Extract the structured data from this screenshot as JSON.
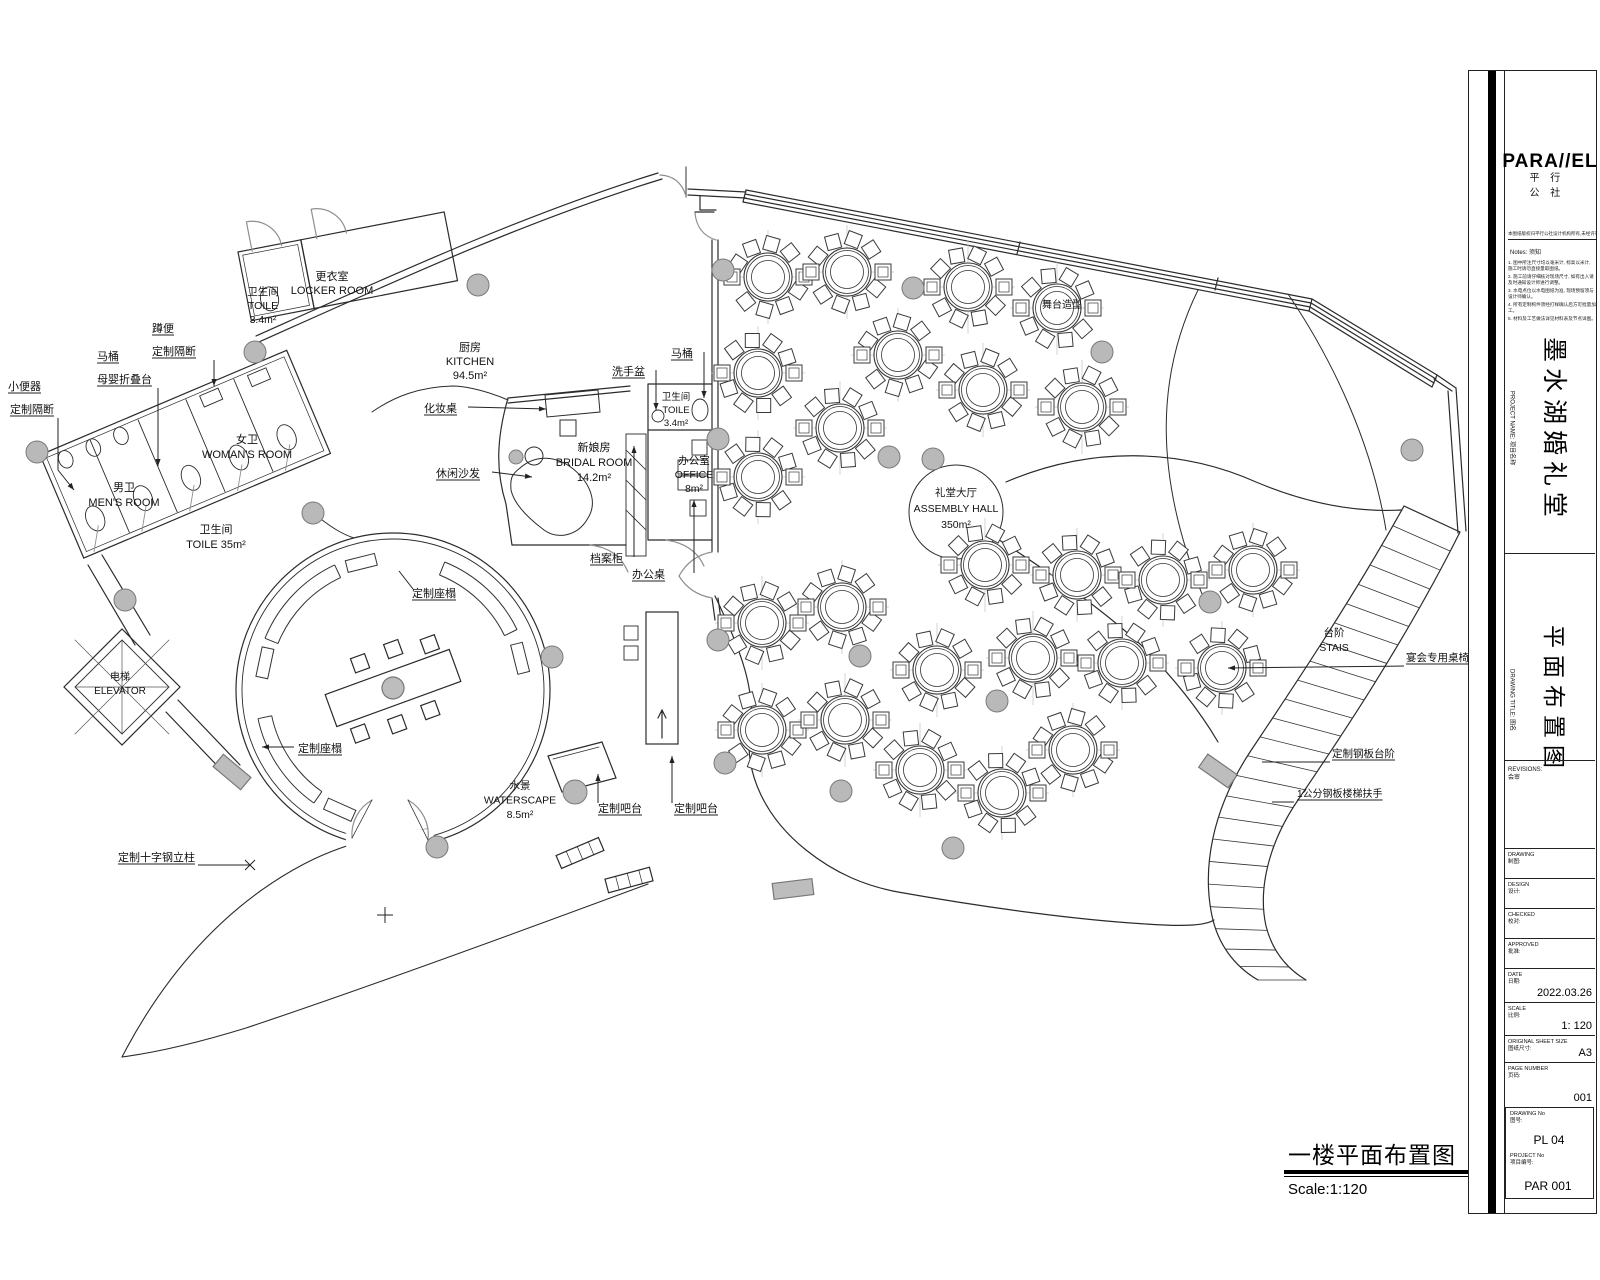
{
  "title_block": {
    "logo": "PARA//EL",
    "logo_sub": "平 行 公 社",
    "copyright_line": "本图纸版权归平行公社设计机构所有,未经许可不得复制",
    "notes_title": "Notes:  须知",
    "notes_items": [
      "1. 图中所注尺寸均以毫米计, 标高以米计, 施工时请勿直接量取图纸。",
      "2. 施工前请仔细核对现场尺寸, 如有出入请及时通知设计师进行调整。",
      "3. 水电点位以水电图纸为准, 现场预留须与设计师确认。",
      "4. 所有定制构件须经打样确认后方可批量加工。",
      "5. 材料及工艺做法详见材料表及节点详图。"
    ],
    "project_name_label": "PROJECT NAME:  项目名称",
    "project_name": "墨水湖婚礼堂",
    "drawing_title_label": "DRAWING TITLE:  图名",
    "drawing_title": "平面布置图",
    "revisions_en": "REVISIONS:",
    "revisions_cn": "会审",
    "fields": [
      {
        "en": "DRAWING",
        "cn": "制图:",
        "value": "",
        "y": 848,
        "h": 30
      },
      {
        "en": "DESIGN",
        "cn": "设计:",
        "value": "",
        "y": 878,
        "h": 30
      },
      {
        "en": "CHECKED",
        "cn": "校对:",
        "value": "",
        "y": 908,
        "h": 30
      },
      {
        "en": "APPROVED",
        "cn": "批准:",
        "value": "",
        "y": 938,
        "h": 30
      },
      {
        "en": "DATE",
        "cn": "日期:",
        "value": "2022.03.26",
        "y": 968,
        "h": 34
      },
      {
        "en": "SCALE",
        "cn": "比例:",
        "value": "1:  120",
        "y": 1002,
        "h": 33
      },
      {
        "en": "ORIGINAL SHEET SIZE",
        "cn": "图纸尺寸:",
        "value": "A3",
        "y": 1035,
        "h": 27
      },
      {
        "en": "PAGE NUMBER",
        "cn": "页码:",
        "value": "001",
        "y": 1062,
        "h": 45
      }
    ],
    "drawing_no_label_en": "DRAWING No",
    "drawing_no_label_cn": "图号:",
    "drawing_no": "PL 04",
    "project_no_label_en": "PROJECT No",
    "project_no_label_cn": "项目编号:",
    "project_no": "PAR 001"
  },
  "plan_title": {
    "cn": "一楼平面布置图",
    "scale": "Scale:1:120"
  },
  "plan": {
    "labels": [
      {
        "x": 332,
        "y": 280,
        "fs": 11,
        "lh": 14,
        "a": "m",
        "lines": [
          "更衣室",
          "LOCKER ROOM"
        ]
      },
      {
        "x": 263,
        "y": 295,
        "fs": 10.5,
        "lh": 14,
        "a": "m",
        "lines": [
          "卫生间",
          "TOILE",
          "3.4m²"
        ]
      },
      {
        "x": 470,
        "y": 351,
        "fs": 11,
        "lh": 14,
        "a": "m",
        "lines": [
          "厨房",
          "KITCHEN",
          "94.5m²"
        ]
      },
      {
        "x": 594,
        "y": 451,
        "fs": 11,
        "lh": 15,
        "a": "m",
        "lines": [
          "新娘房",
          "BRIDAL ROOM",
          "14.2m²"
        ]
      },
      {
        "x": 676,
        "y": 400,
        "fs": 9.5,
        "lh": 13,
        "a": "m",
        "lines": [
          "卫生间",
          "TOILE",
          "3.4m²"
        ]
      },
      {
        "x": 694,
        "y": 464,
        "fs": 10.5,
        "lh": 14,
        "a": "m",
        "lines": [
          "办公室",
          "OFFICE",
          "8m²"
        ]
      },
      {
        "x": 247,
        "y": 443,
        "fs": 11,
        "lh": 15,
        "a": "m",
        "lines": [
          "女卫",
          "WOMAN'S ROOM"
        ]
      },
      {
        "x": 124,
        "y": 491,
        "fs": 11,
        "lh": 15,
        "a": "m",
        "lines": [
          "男卫",
          "MEN'S ROOM"
        ]
      },
      {
        "x": 216,
        "y": 533,
        "fs": 11,
        "lh": 15,
        "a": "m",
        "lines": [
          "卫生间",
          "TOILE 35m²"
        ]
      },
      {
        "x": 120,
        "y": 680,
        "fs": 10,
        "lh": 14,
        "a": "m",
        "lines": [
          "电梯",
          "ELEVATOR"
        ]
      },
      {
        "x": 1334,
        "y": 636,
        "fs": 10.5,
        "lh": 15,
        "a": "m",
        "lines": [
          "台阶",
          "STAIS"
        ]
      },
      {
        "x": 520,
        "y": 789,
        "fs": 10.5,
        "lh": 14.5,
        "a": "m",
        "lines": [
          "水景",
          "WATERSCAPE",
          "8.5m²"
        ]
      },
      {
        "x": 956,
        "y": 496,
        "fs": 10.5,
        "lh": 16,
        "a": "m",
        "lines": [
          "礼堂大厅",
          "ASSEMBLY HALL",
          "350m²"
        ]
      },
      {
        "x": 1062,
        "y": 308,
        "fs": 10,
        "lh": 13,
        "a": "m",
        "lines": [
          "舞台造型"
        ]
      },
      {
        "x": 8,
        "y": 390,
        "ul": true,
        "lines": [
          "小便器"
        ]
      },
      {
        "x": 10,
        "y": 413,
        "ul": true,
        "lines": [
          "定制隔断"
        ]
      },
      {
        "x": 97,
        "y": 360,
        "ul": true,
        "lines": [
          "马桶"
        ]
      },
      {
        "x": 97,
        "y": 383,
        "ul": true,
        "lines": [
          "母婴折叠台"
        ]
      },
      {
        "x": 152,
        "y": 332,
        "ul": true,
        "lines": [
          "蹲便"
        ]
      },
      {
        "x": 152,
        "y": 355,
        "ul": true,
        "lines": [
          "定制隔断"
        ]
      },
      {
        "x": 424,
        "y": 412,
        "ul": true,
        "lines": [
          "化妆桌"
        ]
      },
      {
        "x": 436,
        "y": 477,
        "ul": true,
        "lines": [
          "休闲沙发"
        ]
      },
      {
        "x": 612,
        "y": 375,
        "ul": true,
        "lines": [
          "洗手盆"
        ]
      },
      {
        "x": 671,
        "y": 357,
        "ul": true,
        "lines": [
          "马桶"
        ]
      },
      {
        "x": 590,
        "y": 562,
        "ul": true,
        "lines": [
          "档案柜"
        ]
      },
      {
        "x": 632,
        "y": 578,
        "ul": true,
        "lines": [
          "办公桌"
        ]
      },
      {
        "x": 412,
        "y": 597,
        "ul": true,
        "lines": [
          "定制座榻"
        ]
      },
      {
        "x": 298,
        "y": 752,
        "ul": true,
        "lines": [
          "定制座榻"
        ]
      },
      {
        "x": 598,
        "y": 812,
        "ul": true,
        "lines": [
          "定制吧台"
        ]
      },
      {
        "x": 674,
        "y": 812,
        "ul": true,
        "lines": [
          "定制吧台"
        ]
      },
      {
        "x": 118,
        "y": 861,
        "ul": true,
        "lines": [
          "定制十字钢立柱"
        ]
      },
      {
        "x": 1406,
        "y": 661,
        "fs": 10.5,
        "ul": true,
        "lines": [
          "宴会专用桌椅"
        ]
      },
      {
        "x": 1332,
        "y": 757,
        "fs": 10.5,
        "ul": true,
        "lines": [
          "定制钢板台阶"
        ]
      },
      {
        "x": 1297,
        "y": 797,
        "fs": 10,
        "ul": true,
        "lines": [
          "1公分钢板楼梯扶手"
        ]
      }
    ],
    "leaders": [
      {
        "pts": [
          [
            58,
            418
          ],
          [
            58,
            470
          ],
          [
            74,
            490
          ]
        ],
        "end": "arrow"
      },
      {
        "pts": [
          [
            158,
            388
          ],
          [
            158,
            466
          ]
        ],
        "end": "arrow"
      },
      {
        "pts": [
          [
            214,
            360
          ],
          [
            214,
            386
          ]
        ],
        "end": "arrow"
      },
      {
        "pts": [
          [
            468,
            407
          ],
          [
            546,
            409
          ]
        ],
        "end": "arrow"
      },
      {
        "pts": [
          [
            492,
            472
          ],
          [
            532,
            477
          ]
        ],
        "end": "arrow"
      },
      {
        "pts": [
          [
            656,
            370
          ],
          [
            656,
            410
          ]
        ],
        "end": "arrow"
      },
      {
        "pts": [
          [
            704,
            352
          ],
          [
            704,
            398
          ]
        ],
        "end": "arrow"
      },
      {
        "pts": [
          [
            634,
            557
          ],
          [
            634,
            446
          ]
        ],
        "end": "arrow"
      },
      {
        "pts": [
          [
            694,
            573
          ],
          [
            694,
            500
          ]
        ],
        "end": "arrow"
      },
      {
        "pts": [
          [
            413,
            589
          ],
          [
            399,
            571
          ]
        ],
        "end": "none"
      },
      {
        "pts": [
          [
            294,
            747
          ],
          [
            262,
            747
          ]
        ],
        "end": "arrow"
      },
      {
        "pts": [
          [
            598,
            803
          ],
          [
            598,
            774
          ]
        ],
        "end": "arrow"
      },
      {
        "pts": [
          [
            672,
            803
          ],
          [
            672,
            756
          ]
        ],
        "end": "arrow"
      },
      {
        "pts": [
          [
            198,
            865
          ],
          [
            250,
            865
          ]
        ],
        "end": "x"
      },
      {
        "pts": [
          [
            1404,
            666
          ],
          [
            1228,
            668
          ]
        ],
        "end": "arrow"
      },
      {
        "pts": [
          [
            1330,
            762
          ],
          [
            1262,
            762
          ]
        ],
        "end": "none"
      },
      {
        "pts": [
          [
            1294,
            802
          ],
          [
            1272,
            802
          ]
        ],
        "end": "none"
      },
      {
        "pts": [
          [
            385,
            915
          ]
        ],
        "end": "plus"
      }
    ],
    "tables": [
      [
        768,
        277
      ],
      [
        847,
        272
      ],
      [
        968,
        287
      ],
      [
        1057,
        308
      ],
      [
        758,
        373
      ],
      [
        898,
        355
      ],
      [
        983,
        390
      ],
      [
        1082,
        407
      ],
      [
        840,
        428
      ],
      [
        758,
        477
      ],
      [
        842,
        607
      ],
      [
        762,
        623
      ],
      [
        985,
        565
      ],
      [
        1077,
        575
      ],
      [
        1163,
        580
      ],
      [
        1253,
        570
      ],
      [
        937,
        670
      ],
      [
        1033,
        658
      ],
      [
        1122,
        663
      ],
      [
        1222,
        668
      ],
      [
        762,
        730
      ],
      [
        845,
        720
      ],
      [
        920,
        770
      ],
      [
        1002,
        793
      ],
      [
        1073,
        750
      ]
    ],
    "columns": [
      [
        723,
        270
      ],
      [
        478,
        285
      ],
      [
        913,
        288
      ],
      [
        1102,
        352
      ],
      [
        718,
        439
      ],
      [
        889,
        457
      ],
      [
        933,
        459
      ],
      [
        516,
        457,
        7
      ],
      [
        255,
        352
      ],
      [
        37,
        452
      ],
      [
        313,
        513
      ],
      [
        125,
        600
      ],
      [
        552,
        657
      ],
      [
        718,
        640
      ],
      [
        860,
        656
      ],
      [
        997,
        701
      ],
      [
        1210,
        602
      ],
      [
        725,
        763
      ],
      [
        575,
        792,
        12
      ],
      [
        841,
        791
      ],
      [
        953,
        848
      ],
      [
        437,
        847
      ],
      [
        1412,
        450
      ]
    ],
    "benches": [
      [
        115,
        158
      ],
      [
        192,
        235
      ],
      [
        26,
        68
      ]
    ],
    "bench_caps": [
      [
        104,
        131
      ],
      [
        168,
        131
      ],
      [
        246,
        131
      ],
      [
        14,
        131
      ]
    ]
  }
}
